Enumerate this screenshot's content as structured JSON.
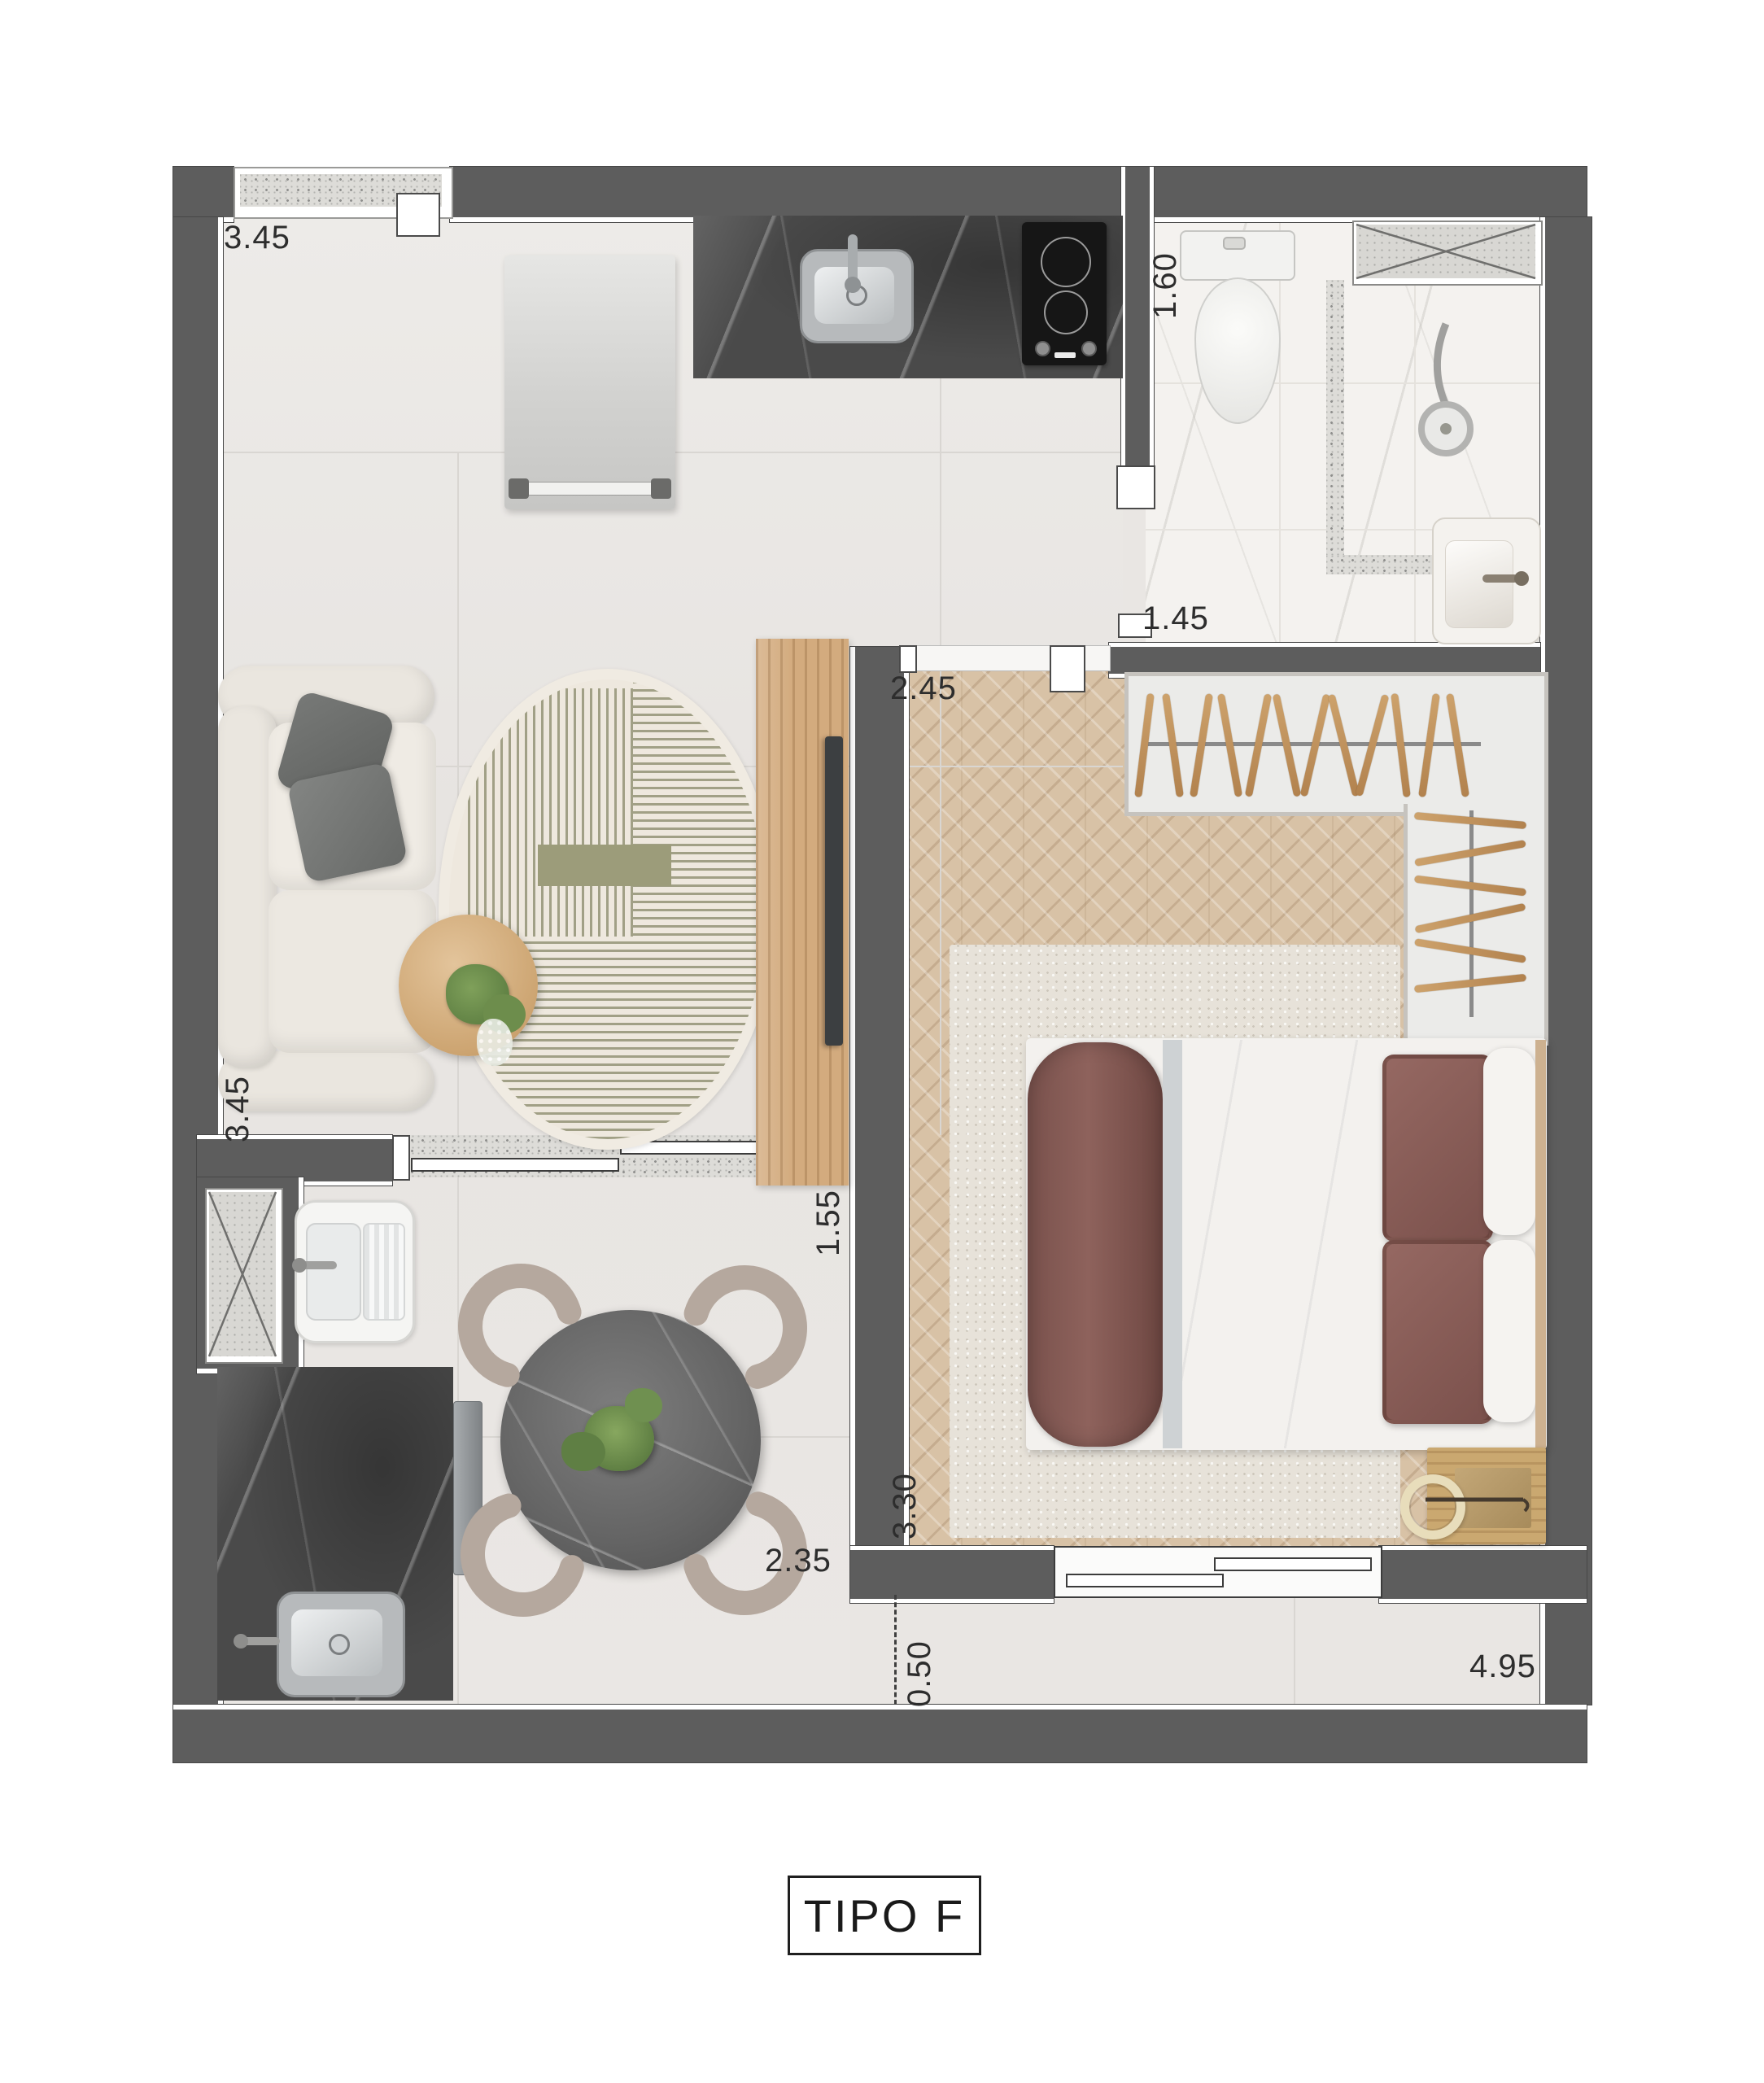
{
  "title": {
    "label": "TIPO F"
  },
  "dimensions": {
    "top_width": "3.45",
    "bath_width": "1.60",
    "bath_door": "1.45",
    "bedroom_width": "2.45",
    "living_depth": "3.45",
    "hall_width": "1.55",
    "bedroom_depth": "3.30",
    "dining_width": "2.35",
    "setback": "0.50",
    "bottom_width": "4.95"
  },
  "colors": {
    "wall": "#5d5d5d",
    "floor": "#e9e6e3",
    "bath_floor": "#f4f2ef",
    "wood_floor": "#d8c2a6",
    "counter_marble": "#4a4a4a",
    "table_marble": "#6b6b6b",
    "chair": "#b5a89e",
    "bedding_brown": "#855c56",
    "brass": "#b59a6b",
    "stripe_olive": "#8e8e70",
    "terrazzo": "#dddcd8"
  },
  "closet": {
    "top_hangers": 12,
    "side_hangers": 6
  },
  "dining": {
    "chair_count": 4
  }
}
